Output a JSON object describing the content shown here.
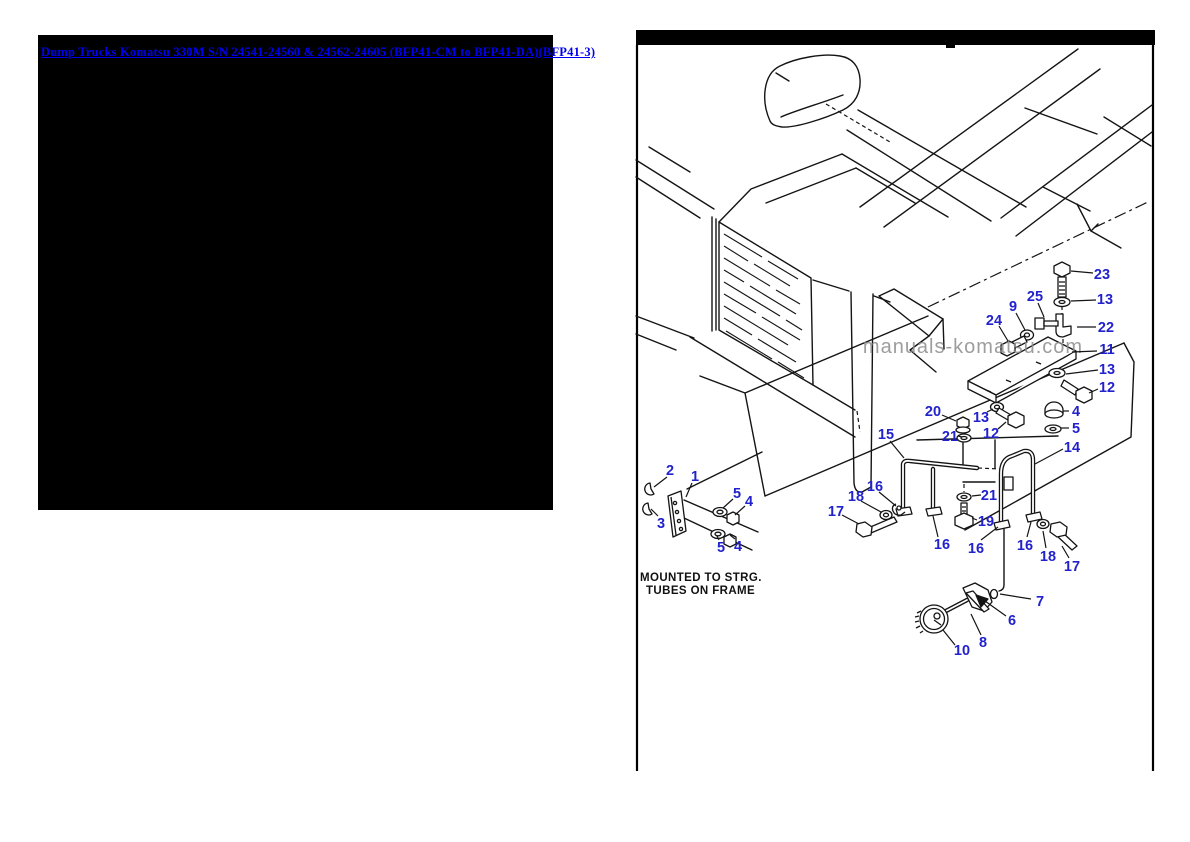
{
  "header": {
    "breadcrumb": "Dump Trucks Komatsu 330M S/N 24541-24560 & 24562-24605 (BFP41-CM to BFP41-DA)(BFP41-3)",
    "link_color": "#0000ee"
  },
  "diagram": {
    "watermark": "manuals-komatsu.com",
    "watermark_color": "#8c8c8c",
    "note": {
      "line1": "MOUNTED TO STRG.",
      "line2": "TUBES ON FRAME"
    },
    "callout_color": "#2222cc",
    "line_color": "#141414",
    "callouts": [
      {
        "n": "1",
        "x": 695,
        "y": 476,
        "l": [
          692,
          483,
          686,
          497
        ]
      },
      {
        "n": "2",
        "x": 670,
        "y": 470,
        "l": [
          667,
          477,
          654,
          487
        ]
      },
      {
        "n": "3",
        "x": 661,
        "y": 523,
        "l": [
          658,
          516,
          651,
          509
        ]
      },
      {
        "n": "5",
        "x": 737,
        "y": 493,
        "l": [
          733,
          499,
          723,
          508
        ]
      },
      {
        "n": "4",
        "x": 749,
        "y": 501,
        "l": [
          745,
          506,
          735,
          515
        ]
      },
      {
        "n": "5",
        "x": 721,
        "y": 547,
        "l": [
          719,
          540,
          717,
          536
        ]
      },
      {
        "n": "4",
        "x": 738,
        "y": 546,
        "l": [
          735,
          539,
          730,
          535
        ]
      },
      {
        "n": "15",
        "x": 886,
        "y": 434,
        "l": [
          890,
          441,
          904,
          458
        ]
      },
      {
        "n": "16",
        "x": 875,
        "y": 486,
        "l": [
          879,
          492,
          896,
          506
        ]
      },
      {
        "n": "18",
        "x": 856,
        "y": 496,
        "l": [
          861,
          501,
          881,
          512
        ]
      },
      {
        "n": "17",
        "x": 836,
        "y": 511,
        "l": [
          842,
          515,
          859,
          524
        ]
      },
      {
        "n": "20",
        "x": 933,
        "y": 411,
        "l": [
          942,
          415,
          956,
          421
        ]
      },
      {
        "n": "13",
        "x": 981,
        "y": 417,
        "l": [
          987,
          412,
          993,
          409
        ]
      },
      {
        "n": "21",
        "x": 950,
        "y": 436,
        "l": [
          958,
          436,
          962,
          437
        ]
      },
      {
        "n": "12",
        "x": 991,
        "y": 433,
        "l": [
          998,
          429,
          1006,
          422
        ]
      },
      {
        "n": "16",
        "x": 942,
        "y": 544,
        "l": [
          938,
          537,
          933,
          516
        ]
      },
      {
        "n": "16",
        "x": 976,
        "y": 548,
        "l": [
          981,
          540,
          998,
          527
        ]
      },
      {
        "n": "19",
        "x": 986,
        "y": 521,
        "l": [
          977,
          520,
          972,
          518
        ]
      },
      {
        "n": "21",
        "x": 989,
        "y": 495,
        "l": [
          981,
          495,
          972,
          496
        ]
      },
      {
        "n": "16",
        "x": 1025,
        "y": 545,
        "l": [
          1027,
          537,
          1031,
          522
        ]
      },
      {
        "n": "18",
        "x": 1048,
        "y": 556,
        "l": [
          1046,
          548,
          1043,
          531
        ]
      },
      {
        "n": "17",
        "x": 1072,
        "y": 566,
        "l": [
          1069,
          558,
          1062,
          546
        ]
      },
      {
        "n": "14",
        "x": 1072,
        "y": 447,
        "l": [
          1063,
          449,
          1035,
          464
        ]
      },
      {
        "n": "24",
        "x": 994,
        "y": 320,
        "l": [
          999,
          326,
          1008,
          341
        ]
      },
      {
        "n": "9",
        "x": 1013,
        "y": 306,
        "l": [
          1016,
          313,
          1025,
          330
        ]
      },
      {
        "n": "25",
        "x": 1035,
        "y": 296,
        "l": [
          1038,
          303,
          1044,
          317
        ]
      },
      {
        "n": "23",
        "x": 1102,
        "y": 274,
        "l": [
          1093,
          273,
          1071,
          271
        ]
      },
      {
        "n": "13",
        "x": 1105,
        "y": 299,
        "l": [
          1096,
          300,
          1071,
          301
        ]
      },
      {
        "n": "22",
        "x": 1106,
        "y": 327,
        "l": [
          1096,
          327,
          1077,
          327
        ]
      },
      {
        "n": "11",
        "x": 1107,
        "y": 349,
        "l": [
          1097,
          351,
          1072,
          352
        ]
      },
      {
        "n": "13",
        "x": 1107,
        "y": 369,
        "l": [
          1098,
          370,
          1066,
          374
        ]
      },
      {
        "n": "12",
        "x": 1107,
        "y": 387,
        "l": [
          1098,
          389,
          1089,
          393
        ]
      },
      {
        "n": "4",
        "x": 1076,
        "y": 411,
        "l": [
          1069,
          411,
          1063,
          411
        ]
      },
      {
        "n": "5",
        "x": 1076,
        "y": 428,
        "l": [
          1069,
          428,
          1061,
          428
        ]
      },
      {
        "n": "7",
        "x": 1040,
        "y": 601,
        "l": [
          1031,
          599,
          1000,
          594
        ]
      },
      {
        "n": "6",
        "x": 1012,
        "y": 620,
        "l": [
          1006,
          616,
          985,
          601
        ]
      },
      {
        "n": "8",
        "x": 983,
        "y": 642,
        "l": [
          981,
          635,
          971,
          614
        ]
      },
      {
        "n": "10",
        "x": 962,
        "y": 650,
        "l": [
          955,
          645,
          943,
          630
        ]
      }
    ]
  }
}
